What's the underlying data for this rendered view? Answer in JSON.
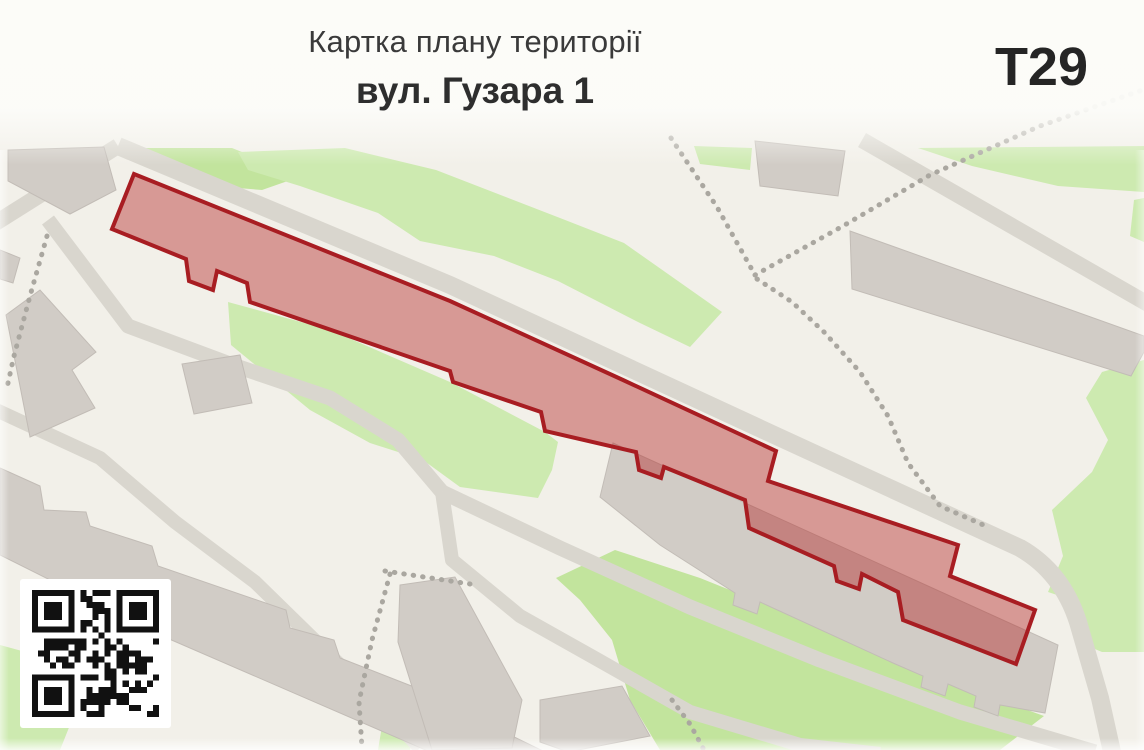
{
  "header": {
    "title": "Картка плану території",
    "subtitle": "вул. Гузара 1",
    "territory_code": "T29"
  },
  "map": {
    "territory": {
      "label": "highlighted-territory",
      "points": "134,174 450,301 623,380 776,451 768,481 958,545 950,576 1035,610 1016,664 903,620 898,592 862,574 859,589 837,581 834,566 749,528 745,500 664,467 661,478 639,470 636,452 545,431 541,412 453,382 450,371 250,302 247,283 217,271 213,290 189,281 186,259 112,229",
      "fill": "rgba(178,34,34,0.42)",
      "stroke": "#a81d22"
    },
    "palette": {
      "background": "#f2f0e9",
      "greenery": "#cdeab0",
      "greenery_alt": "#c2e49d",
      "road": "#d9d6ce",
      "building": "#d1ccc6",
      "building_edge": "#c2bcb6",
      "footpath_dots": "#aaa7a0",
      "territory_fill_visual": "#d5938e",
      "territory_stroke": "#a81d22"
    }
  },
  "qr": {
    "name": "qr-code",
    "modules": 21
  }
}
